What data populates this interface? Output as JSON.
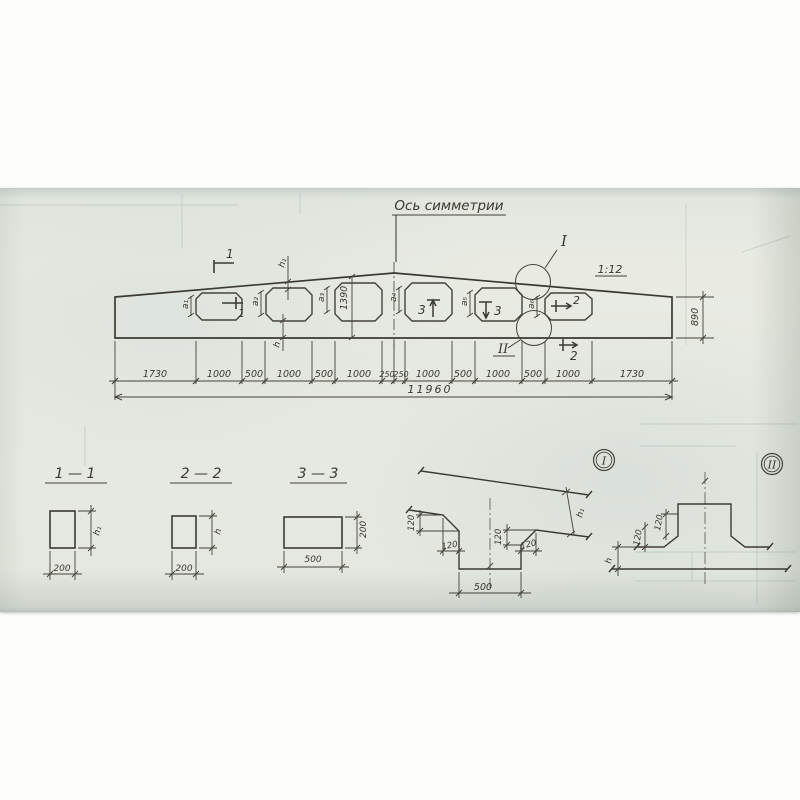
{
  "drawing": {
    "axis_label": "Ось симметрии",
    "slope_label": "1:12",
    "overall_dim": "11960",
    "segments": [
      "1730",
      "1000",
      "500",
      "1000",
      "500",
      "1000",
      "250",
      "250",
      "1000",
      "500",
      "1000",
      "500",
      "1000",
      "1730"
    ],
    "end_height": "890",
    "mid_height": "1390",
    "hole_dims": {
      "a1": "а₁",
      "a2": "а₂",
      "a3": "а₃",
      "a4": "а₄",
      "a5": "а₅",
      "a6": "а₆"
    },
    "flange_top": "h₁",
    "flange_bottom": "h",
    "marks": {
      "s1": "1",
      "s2": "2",
      "s3": "3"
    },
    "callouts": {
      "c1": "I",
      "c2": "II"
    }
  },
  "sections": {
    "s11": {
      "title": "1 — 1",
      "width": "200",
      "height": "h₁"
    },
    "s22": {
      "title": "2 — 2",
      "width": "200",
      "height": "h"
    },
    "s33": {
      "title": "3 — 3",
      "width": "500",
      "height": "200"
    }
  },
  "details": {
    "d1": {
      "label": "I",
      "web_width": "500",
      "chamfer": "120",
      "flange": "h₁"
    },
    "d2": {
      "label": "II",
      "chamfer": "120",
      "flange": "h"
    }
  }
}
